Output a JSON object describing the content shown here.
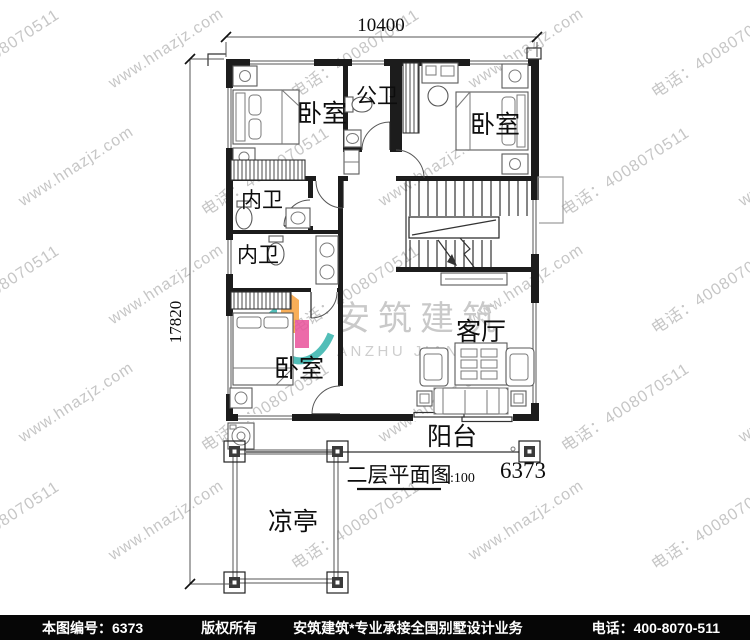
{
  "watermark": {
    "site": "www.hnazjz.com",
    "phone": "电话：4008070511",
    "brand": "安筑建筑",
    "brand_latin": "ANZHU JIANZHU"
  },
  "dimensions": {
    "width_total": "10400",
    "height_total": "17820"
  },
  "rooms": {
    "bedroom_top_left": {
      "label": "卧室"
    },
    "public_bathroom": {
      "label": "公卫"
    },
    "bedroom_top_right": {
      "label": "卧室"
    },
    "ensuite_upper": {
      "label": "内卫"
    },
    "ensuite_lower": {
      "label": "内卫"
    },
    "bedroom_bottom": {
      "label": "卧室"
    },
    "living_room": {
      "label": "客厅"
    },
    "balcony": {
      "label": "阳台"
    },
    "pavilion": {
      "label": "凉亭"
    }
  },
  "title_block": {
    "title": "二层平面图",
    "scale": "1:100",
    "number": "6373"
  },
  "footer": {
    "drawing_no": "本图编号：6373",
    "copyright": "版权所有",
    "slogan": "安筑建筑*专业承接全国别墅设计业务",
    "phone": "电话：400-8070-511"
  },
  "colors": {
    "logo_orange": "#F7A13B",
    "logo_teal": "#35B3AC",
    "logo_magenta": "#E9529B",
    "logo_blue": "#3D57A8",
    "watermark_gray": "#c6c6c6",
    "line_black": "#1c1c1c"
  }
}
